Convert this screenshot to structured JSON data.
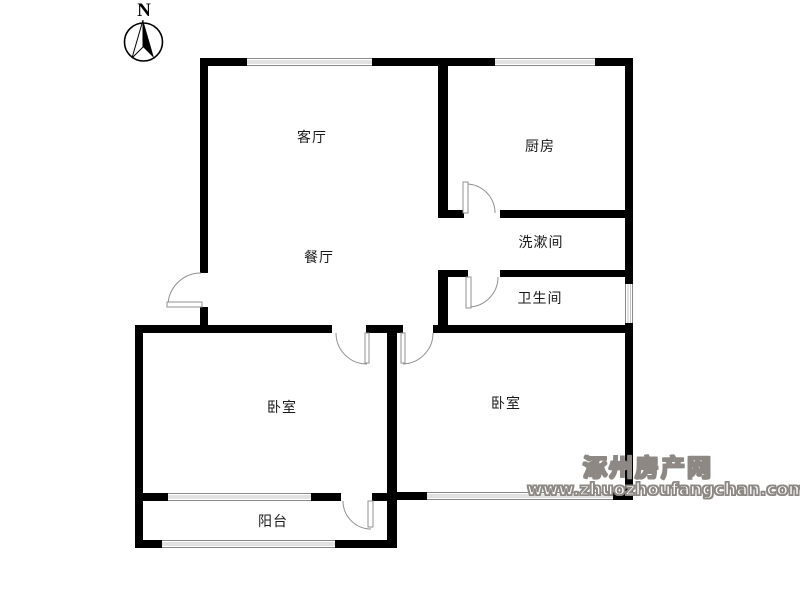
{
  "compass": {
    "label": "N"
  },
  "rooms": {
    "living": {
      "label": "客厅"
    },
    "dining": {
      "label": "餐厅"
    },
    "kitchen": {
      "label": "厨房"
    },
    "washroom": {
      "label": "洗漱间"
    },
    "bathroom": {
      "label": "卫生间"
    },
    "bedroom_left": {
      "label": "卧室"
    },
    "bedroom_right": {
      "label": "卧室"
    },
    "balcony": {
      "label": "阳台"
    }
  },
  "watermark": {
    "site_name": "涿州房产网",
    "url": "www.zhuozhoufangchan.com"
  },
  "colors": {
    "wall": "#000000",
    "window-line": "#8a8a8a",
    "door-line": "#909090",
    "label": "#1a1a1a",
    "watermark": "#8d8883"
  }
}
